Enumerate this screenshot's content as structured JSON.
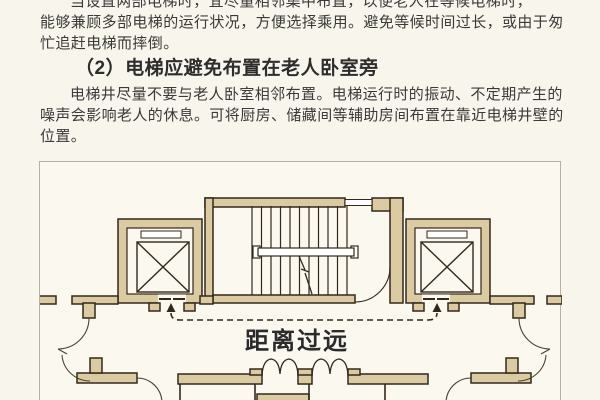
{
  "article": {
    "paragraph1": {
      "note": "first line partially cut off at top of screenshot",
      "text": "当设置两部电梯时，宜尽量相邻集中布置，以便老人在等候电梯时，\n能够兼顾多部电梯的运行状况，方便选择乘用。避免等候时间过长，或由于匆\n忙追赶电梯而摔倒。"
    },
    "heading": "（2）电梯应避免布置在老人卧室旁",
    "paragraph2": {
      "text": "电梯井尽量不要与老人卧室相邻布置。电梯运行时的振动、不定期产生的\n噪声会影响老人的休息。可将厨房、储藏间等辅助房间布置在靠近电梯井壁的\n位置。"
    }
  },
  "figure": {
    "type": "architectural floor plan",
    "caption_label": "距离过远",
    "elements": [
      "left-elevator-shaft",
      "staircase",
      "right-elevator-shaft",
      "corridor-doors",
      "distance-dashed-arrow"
    ],
    "colors": {
      "wall_fill": "#dbcaa2",
      "line": "#33291a",
      "paper": "#fbf8f0",
      "border": "#b7b1a3",
      "page_background": "#f8f5ec",
      "text": "#3a3a3a"
    }
  }
}
